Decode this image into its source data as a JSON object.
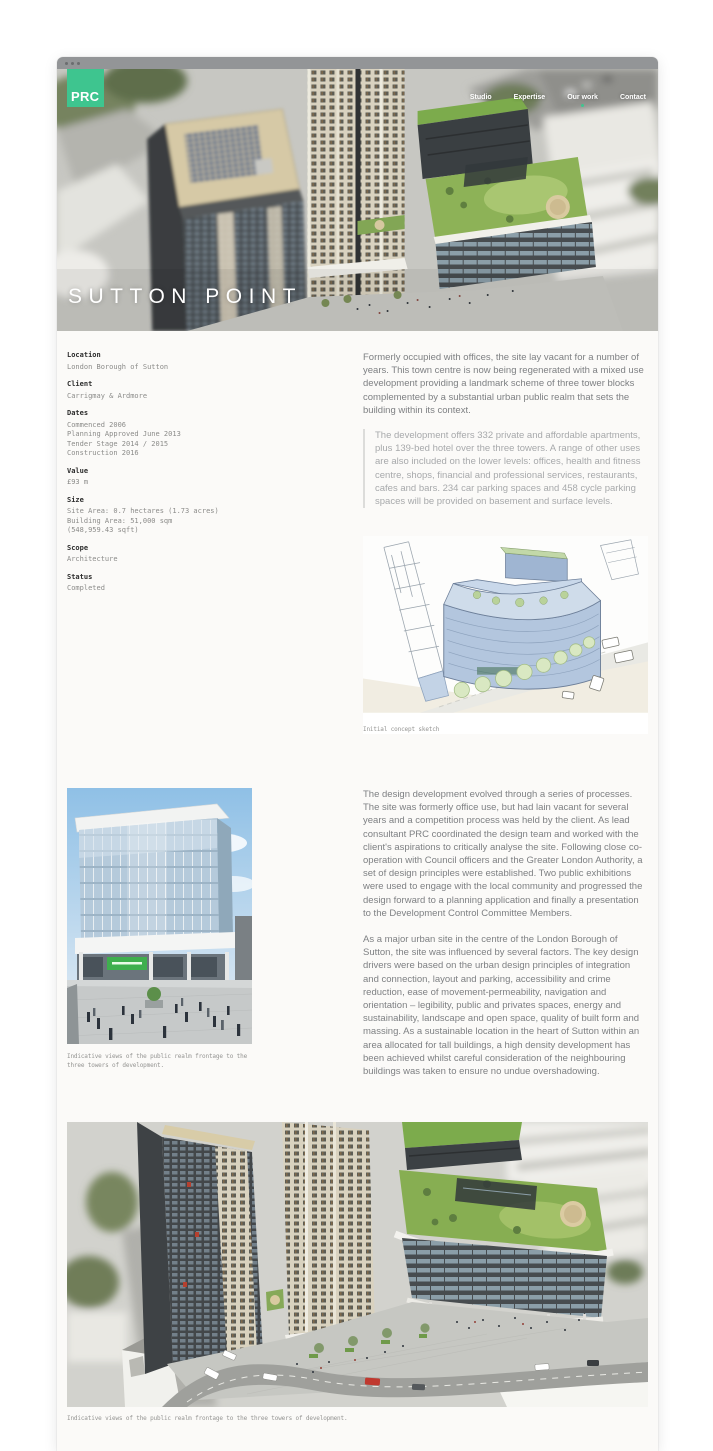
{
  "window": {
    "controls": [
      "close",
      "minimize",
      "maximize"
    ]
  },
  "header": {
    "logo": "PRC",
    "brand_green": "#3ec58f",
    "nav_items": [
      {
        "label": "Studio",
        "active": false
      },
      {
        "label": "Expertise",
        "active": false
      },
      {
        "label": "Our work",
        "active": true
      },
      {
        "label": "Contact",
        "active": false
      }
    ],
    "title": "SUTTON POINT"
  },
  "details": [
    {
      "label": "Location",
      "lines": [
        "London Borough of Sutton"
      ]
    },
    {
      "label": "Client",
      "lines": [
        "Carrigmay & Ardmore"
      ]
    },
    {
      "label": "Dates",
      "lines": [
        "Commenced 2006",
        "Planning Approved June 2013",
        "Tender Stage 2014 / 2015",
        "Construction 2016"
      ]
    },
    {
      "label": "Value",
      "lines": [
        "£93 m"
      ]
    },
    {
      "label": "Size",
      "lines": [
        "Site Area: 0.7 hectares (1.73 acres)",
        "Building Area: 51,000 sqm",
        "(548,959.43 sqft)"
      ]
    },
    {
      "label": "Scope",
      "lines": [
        "Architecture"
      ]
    },
    {
      "label": "Status",
      "lines": [
        "Completed"
      ]
    }
  ],
  "intro": {
    "paragraph": "Formerly occupied with offices, the site lay vacant for a number of years. This town centre is now being regenerated with a mixed use development providing a landmark scheme of three tower blocks complemented by a substantial urban public realm that sets the building within its context.",
    "quote": "The development offers 332 private and affordable apartments, plus 139-bed hotel over the three towers. A range of other uses are also included on the lower levels: offices, health and fitness centre, shops, financial and professional services, restaurants, cafes and bars. 234 car parking spaces and 458 cycle parking spaces will be provided on basement and surface levels."
  },
  "sketch": {
    "caption": "Initial concept sketch"
  },
  "design": {
    "paragraph1": "The design development evolved through a series of processes. The site was formerly office use, but had lain vacant for several years and a competition process was held by the client. As lead consultant PRC coordinated the design team and worked with the client's aspirations to critically analyse the site. Following close co-operation with Council officers and the Greater London Authority, a set of design principles were established. Two public exhibitions were used to engage with the local community and progressed the design forward to a planning application and finally a presentation to the Development Control Committee Members.",
    "paragraph2": "As a major urban site in the centre of the London Borough of Sutton, the site was influenced by several factors. The key design drivers were based on the urban design principles of integration and connection, layout and parking, accessibility and crime reduction, ease of movement-permeability, navigation and orientation – legibility, public and privates spaces, energy and sustainability, landscape and open space, quality of built form and massing. As a sustainable location in the heart of Sutton within an area allocated for tall buildings, a high density development has been achieved whilst careful consideration of the neighbouring buildings was taken to ensure no undue overshadowing."
  },
  "photo": {
    "caption": "Indicative views of the public realm frontage to the three towers of development."
  },
  "aerial": {
    "caption": "Indicative views of the public realm frontage to the three towers of development."
  }
}
